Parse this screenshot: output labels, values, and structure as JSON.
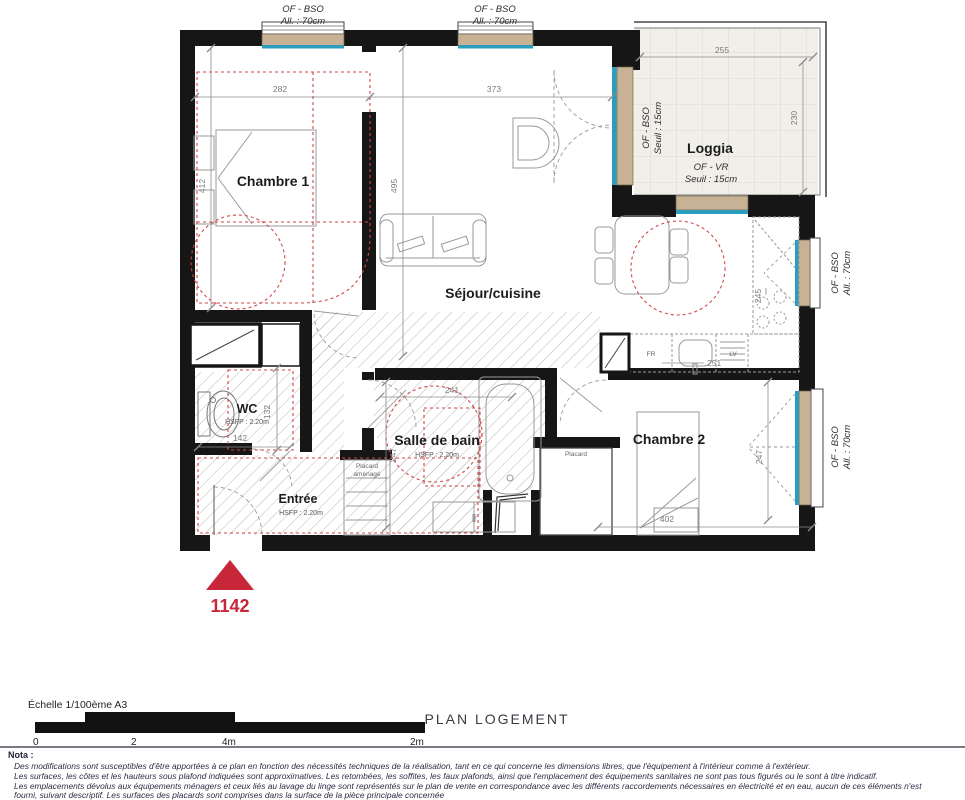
{
  "title": "PLAN LOGEMENT",
  "unit": {
    "number": "1142"
  },
  "scale": {
    "label": "Échelle 1/100ème A3",
    "ticks": [
      "0",
      "2",
      "4m",
      "2m"
    ]
  },
  "windows": {
    "top1": {
      "l1": "OF - BSO",
      "l2": "All. : 70cm"
    },
    "top2": {
      "l1": "OF - BSO",
      "l2": "All. : 70cm"
    },
    "right1": {
      "l1": "OF - BSO",
      "l2": "All. : 70cm"
    },
    "right2": {
      "l1": "OF - BSO",
      "l2": "All. : 70cm"
    }
  },
  "rooms": {
    "chambre1": {
      "name": "Chambre 1",
      "dim_w": "282",
      "dim_h": "412"
    },
    "sejour": {
      "name": "Séjour/cuisine",
      "dim_w": "373",
      "dim_h": "495"
    },
    "loggia": {
      "name": "Loggia",
      "dim_w": "255",
      "dim_h": "230",
      "window_left": {
        "l1": "OF - BSO",
        "l2": "Seuil : 15cm"
      },
      "window_bottom": {
        "l1": "OF - VR",
        "l2": "Seuil : 15cm"
      }
    },
    "wc": {
      "name": "WC",
      "hsfp": "HSFP : 2.20m",
      "dim_w": "142",
      "dim_h": "132"
    },
    "sdb": {
      "name": "Salle de bain",
      "hsfp": "HSFP : 2.20m",
      "dim_w": "241",
      "dim_h": "247"
    },
    "entree": {
      "name": "Entrée",
      "hsfp": "HSFP : 2.20m"
    },
    "chambre2": {
      "name": "Chambre 2",
      "dim_w": "402",
      "dim_h": "247"
    },
    "placard": {
      "name": "Placard"
    },
    "placard_amenage": {
      "l1": "Placard",
      "l2": "aménagé"
    }
  },
  "kitchen": {
    "fr": "FR",
    "lv": "LV",
    "dim_counter": "251",
    "dim_height": "245"
  },
  "colors": {
    "wall": "#161616",
    "window_tan": "#c8b295",
    "glazing_blue": "#2b9dbd",
    "accent_red": "#c8273a",
    "red_dash": "#d04545"
  },
  "nota": {
    "heading": "Nota :",
    "lines": [
      "Des modifications sont susceptibles d'être apportées à ce plan en fonction des nécessités techniques de la réalisation, tant en ce qui concerne les dimensions libres, que l'équipement à l'intérieur comme à l'extérieur.",
      "Les surfaces, les côtes et les hauteurs sous plafond indiquées sont approximatives. Les retombées, les soffites, les faux plafonds, ainsi que l'emplacement des équipements sanitaires ne sont pas tous figurés ou le sont à titre indicatif.",
      "Les emplacements dévolus aux équipements ménagers et ceux liés au lavage du linge sont représentés sur le plan de vente en correspondance avec les différents raccordements nécessaires en électricité et en eau, aucun de ces éléments n'est",
      "fourni, suivant descriptif. Les surfaces des placards sont comprises dans la surface de la pièce principale concernée"
    ]
  }
}
